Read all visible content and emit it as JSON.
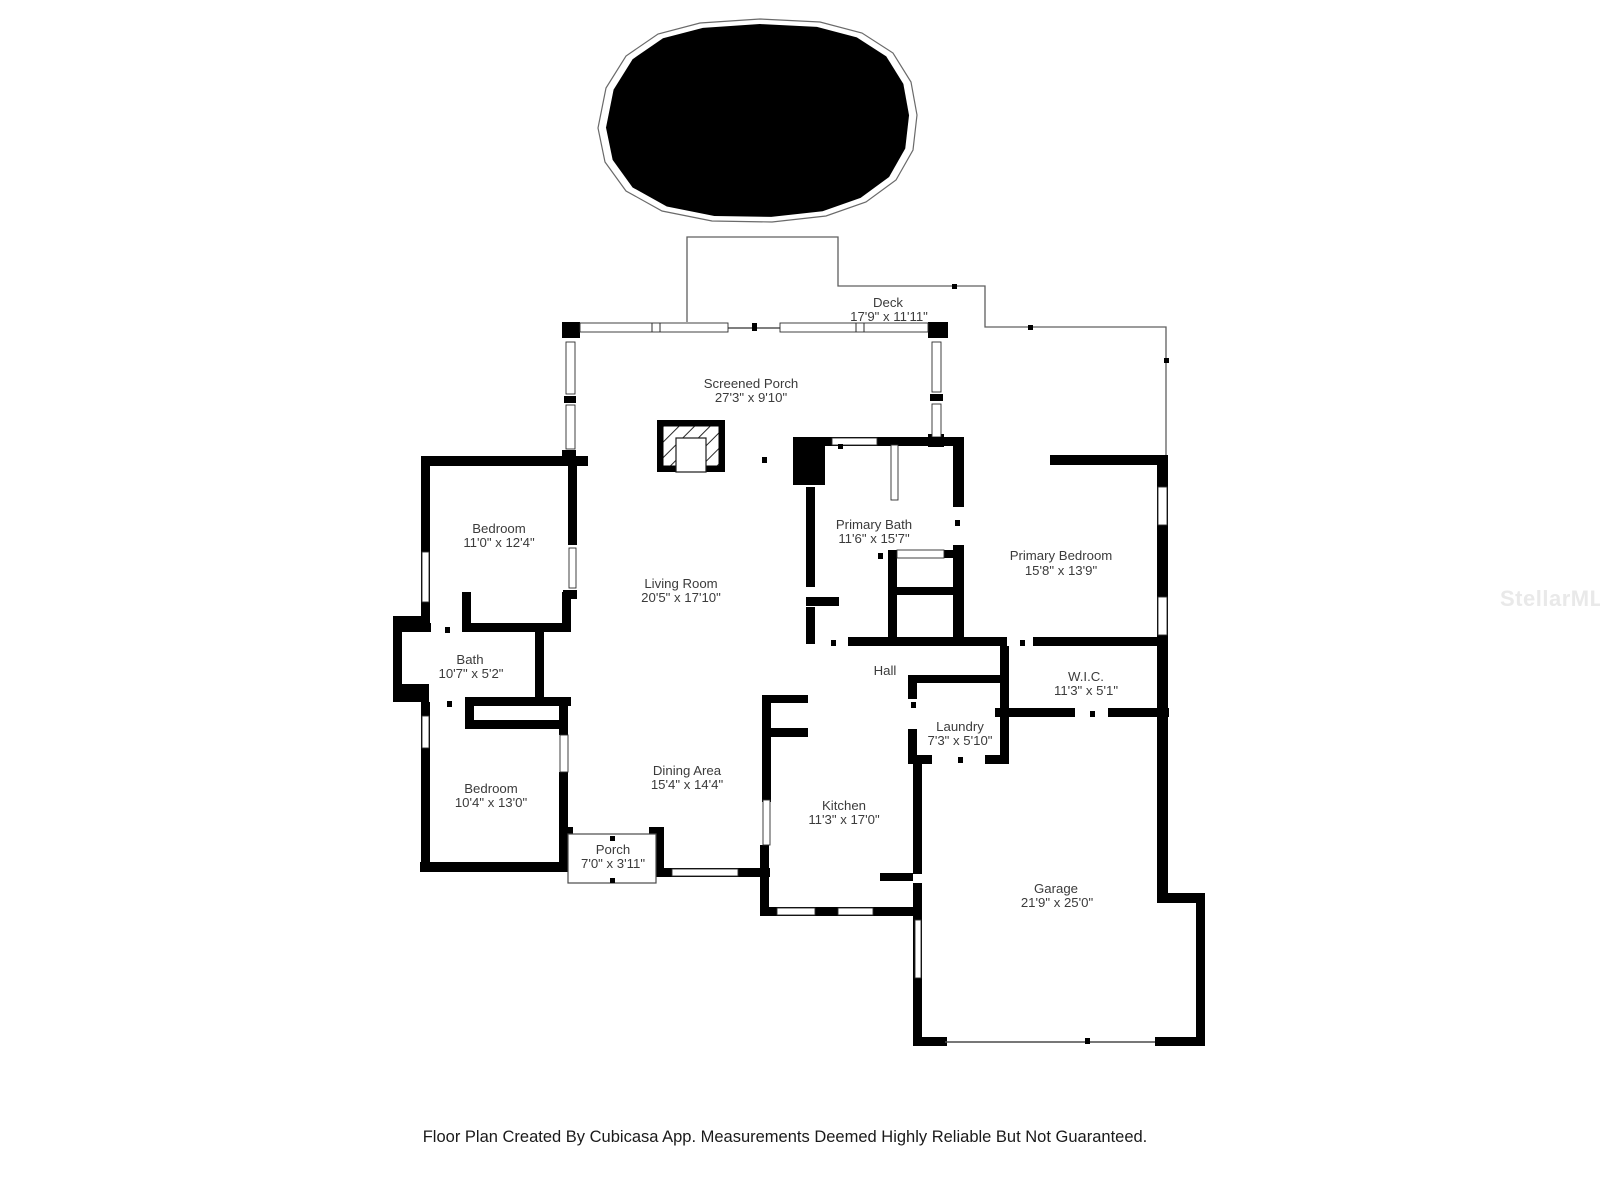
{
  "watermark": {
    "text": "StellarMLS"
  },
  "footer": {
    "text": "Floor Plan Created By Cubicasa App. Measurements Deemed Highly Reliable But Not Guaranteed."
  },
  "plan": {
    "wall_color": "#000000",
    "label_color": "#3b3b3b",
    "rooms": [
      {
        "id": "deck",
        "name": "Deck",
        "dims": "17'9\" x 11'11\""
      },
      {
        "id": "screened-porch",
        "name": "Screened Porch",
        "dims": "27'3\" x 9'10\""
      },
      {
        "id": "bedroom-top",
        "name": "Bedroom",
        "dims": "11'0\" x 12'4\""
      },
      {
        "id": "living-room",
        "name": "Living Room",
        "dims": "20'5\" x 17'10\""
      },
      {
        "id": "primary-bath",
        "name": "Primary Bath",
        "dims": "11'6\" x 15'7\""
      },
      {
        "id": "primary-bedroom",
        "name": "Primary Bedroom",
        "dims": "15'8\" x 13'9\""
      },
      {
        "id": "bath",
        "name": "Bath",
        "dims": "10'7\" x 5'2\""
      },
      {
        "id": "hall",
        "name": "Hall",
        "dims": ""
      },
      {
        "id": "wic",
        "name": "W.I.C.",
        "dims": "11'3\" x 5'1\""
      },
      {
        "id": "laundry",
        "name": "Laundry",
        "dims": "7'3\" x 5'10\""
      },
      {
        "id": "bedroom-bottom",
        "name": "Bedroom",
        "dims": "10'4\" x 13'0\""
      },
      {
        "id": "dining-area",
        "name": "Dining Area",
        "dims": "15'4\" x 14'4\""
      },
      {
        "id": "kitchen",
        "name": "Kitchen",
        "dims": "11'3\" x 17'0\""
      },
      {
        "id": "porch",
        "name": "Porch",
        "dims": "7'0\" x 3'11\""
      },
      {
        "id": "garage",
        "name": "Garage",
        "dims": "21'9\" x 25'0\""
      }
    ]
  }
}
